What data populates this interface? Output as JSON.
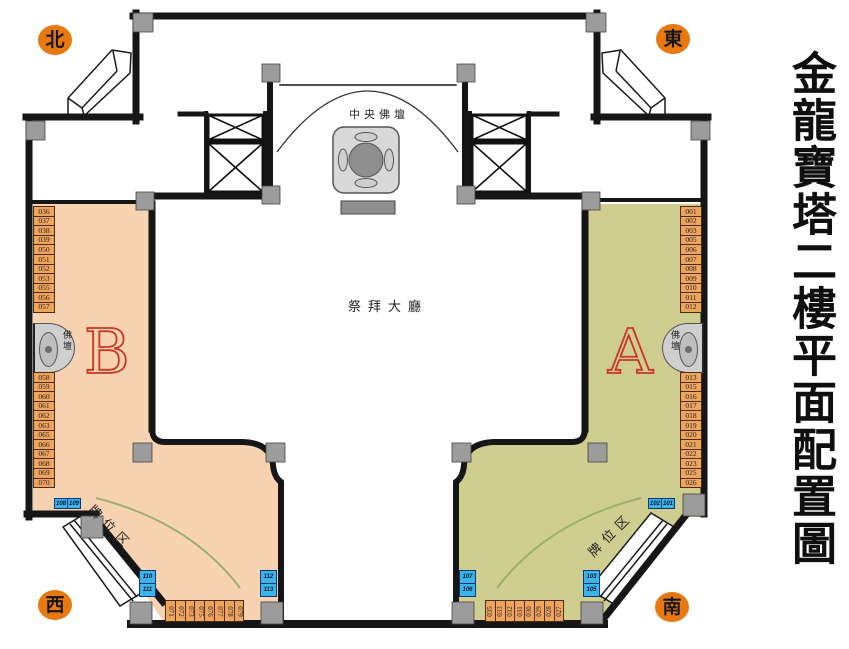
{
  "title": "金龍寶塔二樓平面配置圖",
  "compass": {
    "north": "北",
    "east": "東",
    "west": "西",
    "south": "南"
  },
  "hall": {
    "central_altar_label": "中央佛壇",
    "worship_hall_label": "祭拜大廳"
  },
  "zones": {
    "b": {
      "letter": "B",
      "altar_label": "佛壇",
      "tablet_area_label": "牌位区",
      "column_top": [
        "036",
        "037",
        "038",
        "039",
        "050",
        "051",
        "052",
        "053",
        "055",
        "056",
        "057"
      ],
      "column_bottom": [
        "058",
        "059",
        "060",
        "061",
        "062",
        "063",
        "065",
        "066",
        "067",
        "068",
        "069",
        "070"
      ],
      "bottom_row": [
        "071",
        "072",
        "073",
        "075",
        "076",
        "077",
        "078",
        "079"
      ],
      "service_top": [
        "108",
        "109"
      ],
      "service_left": [
        "110",
        "111"
      ],
      "service_right": [
        "112",
        "113"
      ]
    },
    "a": {
      "letter": "A",
      "altar_label": "佛壇",
      "tablet_area_label": "牌位区",
      "column_top": [
        "001",
        "002",
        "003",
        "005",
        "006",
        "007",
        "008",
        "009",
        "010",
        "011",
        "012"
      ],
      "column_bottom": [
        "013",
        "015",
        "016",
        "017",
        "018",
        "019",
        "020",
        "021",
        "022",
        "023",
        "025",
        "026"
      ],
      "bottom_row": [
        "035",
        "033",
        "032",
        "031",
        "030",
        "029",
        "028",
        "027"
      ],
      "service_top": [
        "102",
        "101"
      ],
      "service_left": [
        "107",
        "106"
      ],
      "service_right": [
        "103",
        "105"
      ]
    }
  },
  "colors": {
    "zone_b_fill": "#f7d3b2",
    "zone_a_fill": "#cfcd8f",
    "cell_fill": "#f0a55c",
    "service_cell_fill": "#3ab5e8",
    "badge_fill": "#e8790f",
    "wall": "#161616",
    "accent_letter": "#cc3524",
    "column_fill": "#9c9c9c",
    "green_arc": "#9aaf70"
  }
}
